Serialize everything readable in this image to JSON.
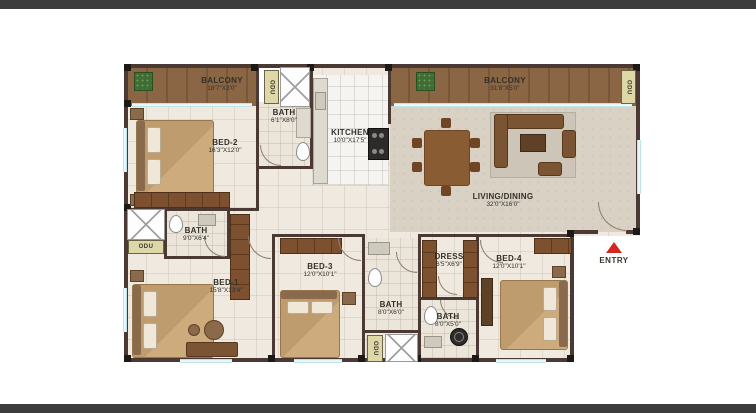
{
  "rooms": {
    "balcony_left": {
      "name": "BALCONY",
      "dims": "18'7\"X3'0\""
    },
    "bed2": {
      "name": "BED-2",
      "dims": "16'3\"X12'0\""
    },
    "bath_top": {
      "name": "BATH",
      "dims": "6'1\"X8'0\""
    },
    "kitchen": {
      "name": "KITCHEN",
      "dims": "10'0\"X17'5\""
    },
    "balcony_right": {
      "name": "BALCONY",
      "dims": "31'8\"X5'0\""
    },
    "living": {
      "name": "LIVING/DINING",
      "dims": "32'0\"X16'0\""
    },
    "bath_mid": {
      "name": "BATH",
      "dims": "9'0\"X6'4\""
    },
    "bed1": {
      "name": "BED-1",
      "dims": "15'8\"X13'4\""
    },
    "bed3": {
      "name": "BED-3",
      "dims": "12'0\"X10'1\""
    },
    "bath_bottom_mid": {
      "name": "BATH",
      "dims": "8'0\"X6'0\""
    },
    "dress": {
      "name": "DRESS",
      "dims": "6'5\"X6'9\""
    },
    "bed4": {
      "name": "BED-4",
      "dims": "12'0\"X10'1\""
    },
    "bath_bottom_right": {
      "name": "BATH",
      "dims": "8'0\"X5'0\""
    }
  },
  "labels": {
    "entry": "ENTRY",
    "odu": "ODU"
  },
  "colors": {
    "wall": "#4a3a33",
    "balcony_wood": "#8a6645",
    "floor": "#efe9df",
    "living_floor": "#d9d1c3",
    "window": "#a9dbe3",
    "wardrobe": "#7d5130",
    "entry_arrow": "#d2281e",
    "plant": "#3f6d33",
    "frame_bar": "#3c3c3c"
  }
}
